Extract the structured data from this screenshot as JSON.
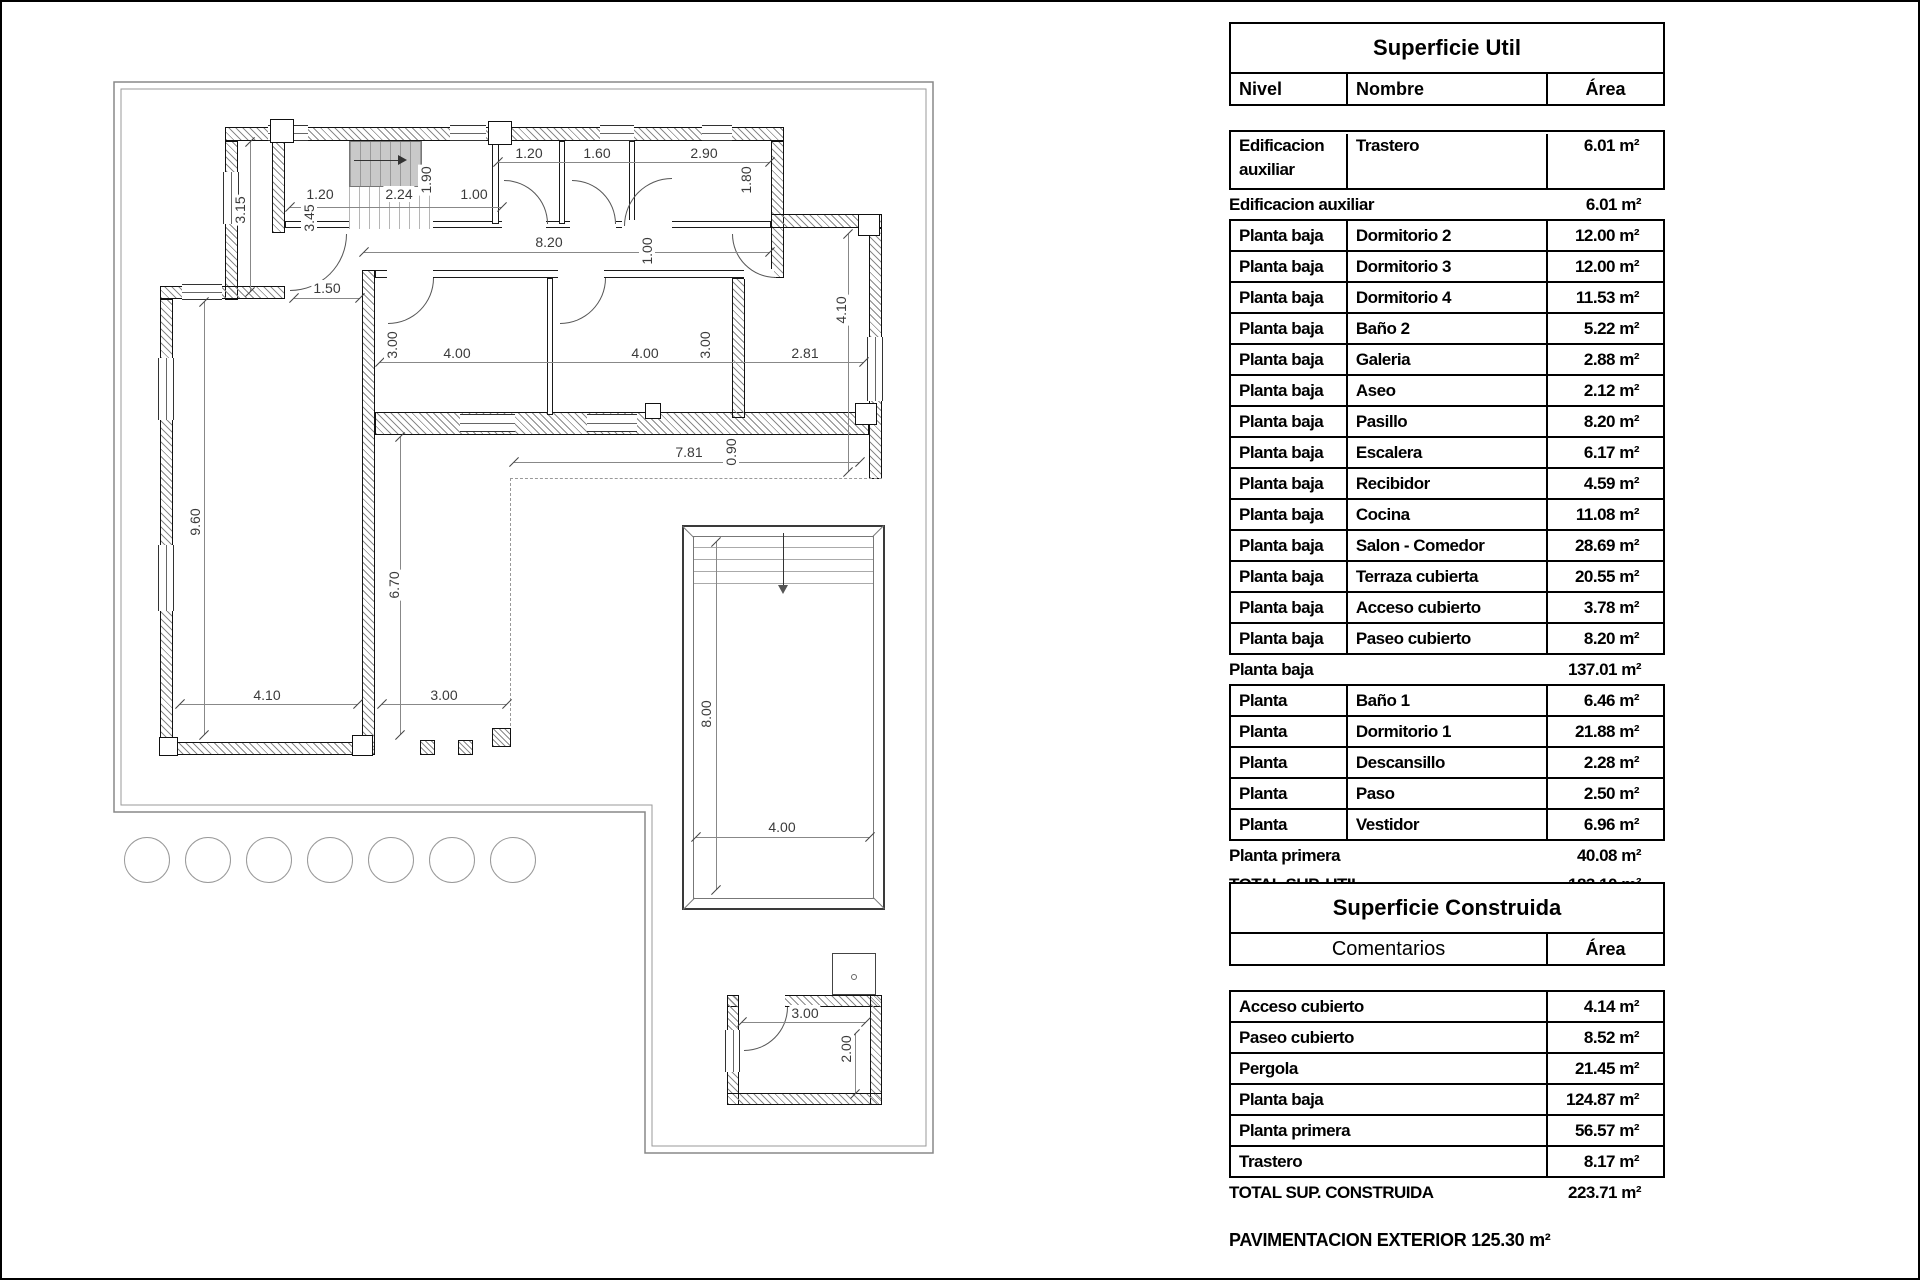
{
  "plan": {
    "dims": [
      "3.15",
      "1.20",
      "3.45",
      "2.24",
      "1.90",
      "1.00",
      "1.20",
      "1.60",
      "2.90",
      "1.80",
      "8.20",
      "1.00",
      "1.50",
      "3.00",
      "4.00",
      "3.00",
      "4.00",
      "2.81",
      "4.10",
      "7.81",
      "0.90",
      "9.60",
      "6.70",
      "4.10",
      "3.00",
      "8.00",
      "4.00",
      "3.00",
      "2.00"
    ],
    "tree_count": 7
  },
  "tables": {
    "util": {
      "title": "Superficie Util",
      "headers": [
        "Nivel",
        "Nombre",
        "Área"
      ],
      "sections": [
        {
          "kind": "box",
          "tall": true,
          "rows": [
            {
              "nivel": "Edificacion auxiliar",
              "nombre": "Trastero",
              "area": "6.01 m²"
            }
          ]
        },
        {
          "kind": "flat",
          "label": "Edificacion auxiliar",
          "area": "6.01 m²"
        },
        {
          "kind": "box",
          "rows": [
            {
              "nivel": "Planta baja",
              "nombre": "Dormitorio 2",
              "area": "12.00 m²"
            },
            {
              "nivel": "Planta baja",
              "nombre": "Dormitorio 3",
              "area": "12.00 m²"
            },
            {
              "nivel": "Planta baja",
              "nombre": "Dormitorio 4",
              "area": "11.53 m²"
            },
            {
              "nivel": "Planta baja",
              "nombre": "Baño 2",
              "area": "5.22 m²"
            },
            {
              "nivel": "Planta baja",
              "nombre": "Galeria",
              "area": "2.88 m²"
            },
            {
              "nivel": "Planta baja",
              "nombre": "Aseo",
              "area": "2.12 m²"
            },
            {
              "nivel": "Planta baja",
              "nombre": "Pasillo",
              "area": "8.20 m²"
            },
            {
              "nivel": "Planta baja",
              "nombre": "Escalera",
              "area": "6.17 m²"
            },
            {
              "nivel": "Planta baja",
              "nombre": "Recibidor",
              "area": "4.59 m²"
            },
            {
              "nivel": "Planta baja",
              "nombre": "Cocina",
              "area": "11.08 m²"
            },
            {
              "nivel": "Planta baja",
              "nombre": "Salon - Comedor",
              "area": "28.69 m²"
            },
            {
              "nivel": "Planta baja",
              "nombre": "Terraza cubierta",
              "area": "20.55 m²"
            },
            {
              "nivel": "Planta baja",
              "nombre": "Acceso cubierto",
              "area": "3.78 m²"
            },
            {
              "nivel": "Planta baja",
              "nombre": "Paseo cubierto",
              "area": "8.20 m²"
            }
          ]
        },
        {
          "kind": "flat",
          "label": "Planta baja",
          "area": "137.01 m²"
        },
        {
          "kind": "box",
          "rows": [
            {
              "nivel": "Planta primera",
              "nombre": "Baño 1",
              "area": "6.46 m²"
            },
            {
              "nivel": "Planta primera",
              "nombre": "Dormitorio 1",
              "area": "21.88 m²"
            },
            {
              "nivel": "Planta primera",
              "nombre": "Descansillo",
              "area": "2.28 m²"
            },
            {
              "nivel": "Planta primera",
              "nombre": "Paso",
              "area": "2.50 m²"
            },
            {
              "nivel": "Planta primera",
              "nombre": "Vestidor",
              "area": "6.96 m²"
            }
          ]
        },
        {
          "kind": "flat",
          "label": "Planta primera",
          "area": "40.08 m²"
        },
        {
          "kind": "flat",
          "total": true,
          "label": "TOTAL SUP. UTIL",
          "area": "183.10 m²"
        }
      ]
    },
    "construida": {
      "title": "Superficie Construida",
      "headers": [
        "Comentarios",
        "Área"
      ],
      "sections": [
        {
          "kind": "box",
          "rows": [
            {
              "nombre": "Acceso cubierto",
              "area": "4.14 m²"
            },
            {
              "nombre": "Paseo cubierto",
              "area": "8.52 m²"
            },
            {
              "nombre": "Pergola",
              "area": "21.45 m²"
            },
            {
              "nombre": "Planta baja",
              "area": "124.87 m²"
            },
            {
              "nombre": "Planta primera",
              "area": "56.57 m²"
            },
            {
              "nombre": "Trastero",
              "area": "8.17 m²"
            }
          ]
        },
        {
          "kind": "flat",
          "total": true,
          "label": "TOTAL SUP. CONSTRUIDA",
          "area": "223.71 m²"
        }
      ]
    },
    "footnote": "PAVIMENTACION EXTERIOR 125.30 m²"
  }
}
